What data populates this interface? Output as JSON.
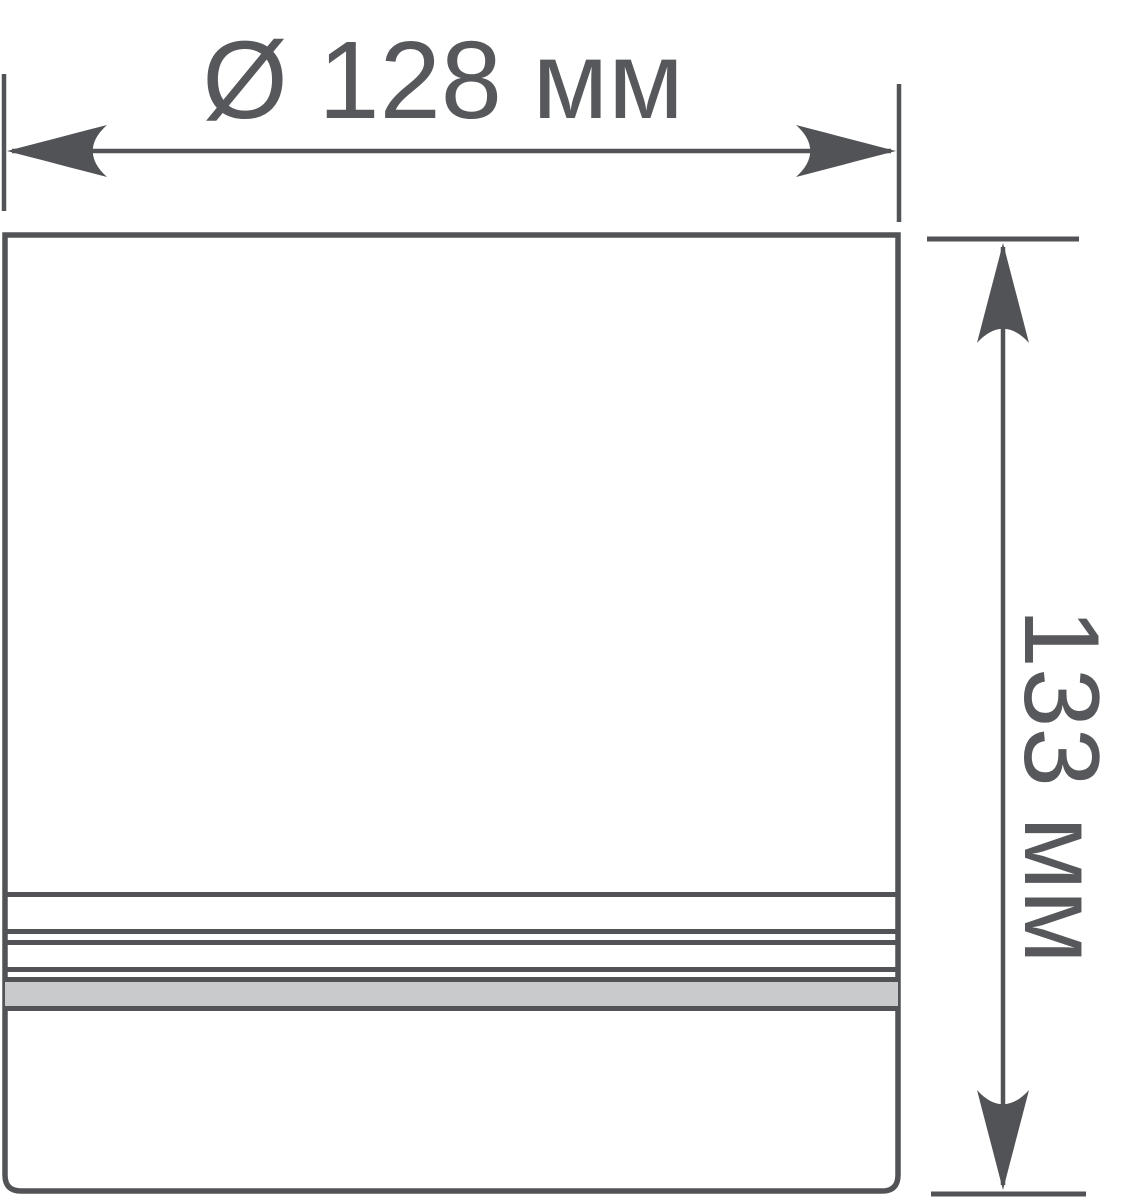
{
  "drawing": {
    "type": "technical-dimension-drawing",
    "dimensions": {
      "diameter": {
        "label": "Ø 128 мм",
        "value_mm": 128
      },
      "height": {
        "label": "133 мм",
        "value_mm": 133
      },
      "unit": "мм"
    },
    "icons": {
      "diameter_arrow": "horizontal-double-headed-arrow",
      "height_arrow": "vertical-double-headed-arrow"
    },
    "colors": {
      "line": "#515356",
      "text": "#57585B",
      "band_fill": "#C9CACB",
      "background": "#FFFFFF"
    }
  }
}
